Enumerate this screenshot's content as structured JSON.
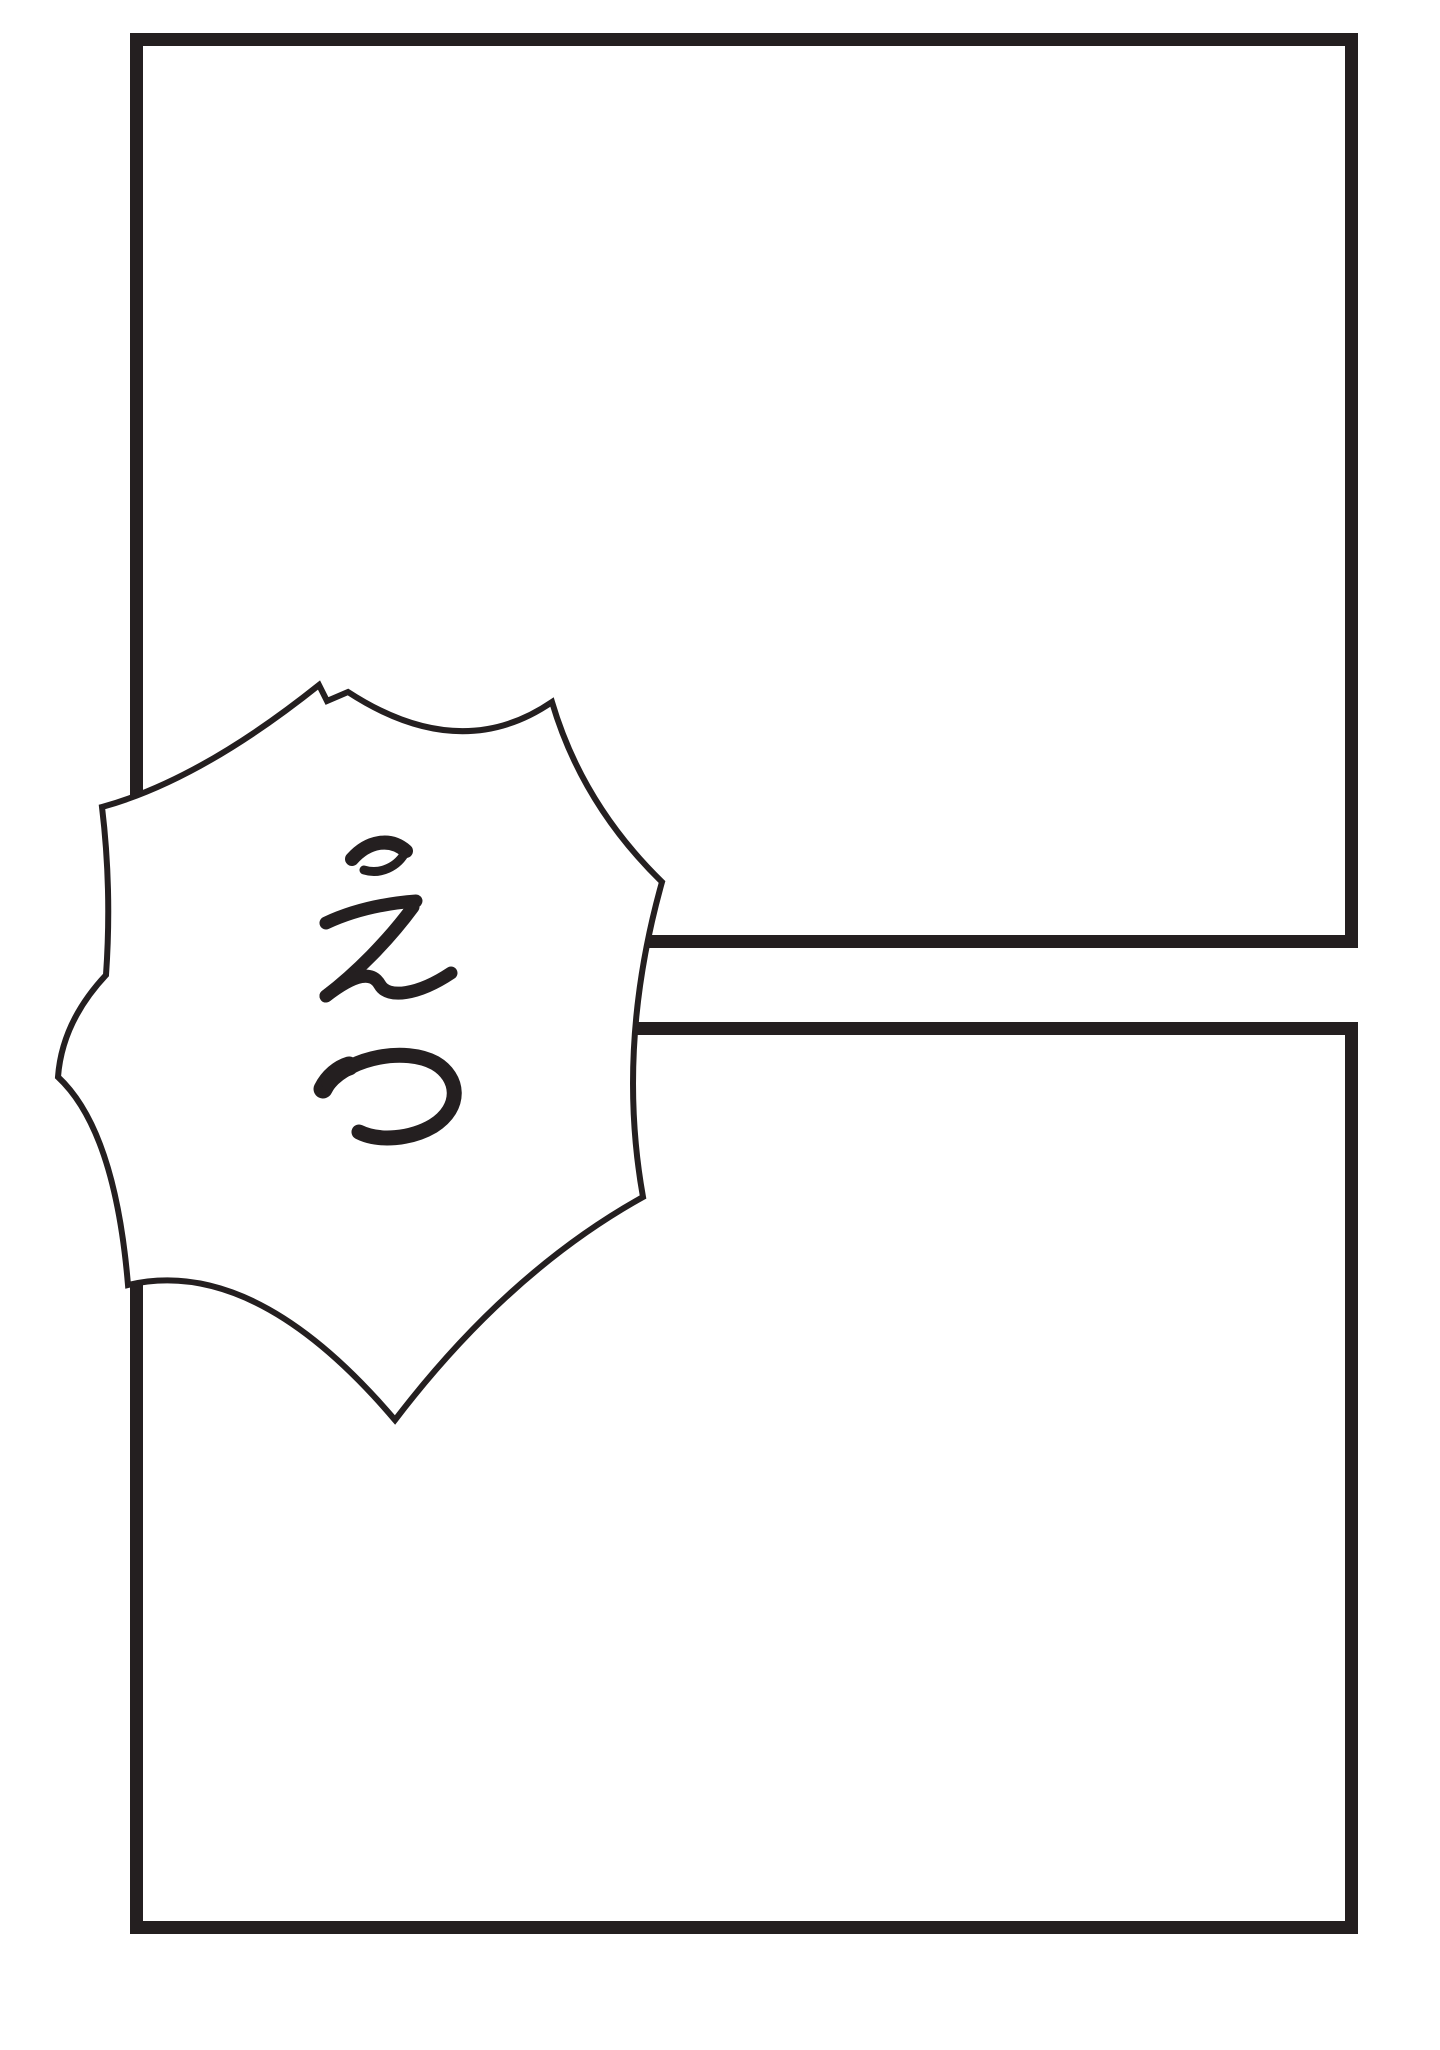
{
  "page": {
    "background_color": "#ffffff",
    "ink_color": "#241f20"
  },
  "panels": {
    "top": {
      "content": ""
    },
    "bottom": {
      "content": ""
    }
  },
  "speech_bubble": {
    "style": "burst",
    "writing_mode": "vertical",
    "text": "えつ",
    "chars": [
      "え",
      "つ"
    ],
    "fill_color": "#ffffff",
    "outline_color": "#241f20"
  }
}
